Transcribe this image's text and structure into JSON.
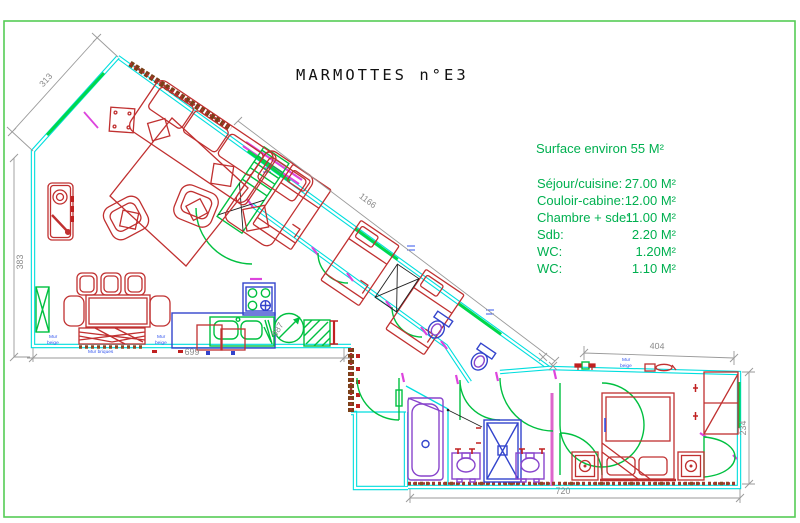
{
  "sheet": {
    "title": "MARMOTTES n°E3"
  },
  "legend": {
    "surface_total": "Surface environ 55 M²",
    "rows": [
      {
        "label": "Séjour/cuisine:",
        "value": "27.00 M²"
      },
      {
        "label": "Couloir-cabine:",
        "value": "12.00 M²"
      },
      {
        "label": "Chambre + sde:",
        "value": "11.00 M²"
      },
      {
        "label": "Sdb:",
        "value": "2.20 M²"
      },
      {
        "label": "WC:",
        "value": "1.20M²"
      },
      {
        "label": "WC:",
        "value": "1.10 M²"
      }
    ]
  },
  "dimensions": {
    "diag_top_left": "313",
    "left_vertical": "383",
    "facade_diagonal": "1166",
    "kitchen_bottom": "699",
    "bedroom_top": "404",
    "bedroom_bottom": "720",
    "bedroom_right": "234",
    "stair_circle": "987"
  },
  "wall_labels": {
    "left": {
      "l1": "Mur",
      "l2": "beige"
    },
    "center": {
      "l1": "Mur briques",
      "l2": ""
    },
    "right": {
      "l1": "Mur",
      "l2": "beige"
    },
    "bedroom": {
      "l1": "Mur",
      "l2": "beige"
    }
  },
  "colors": {
    "wall_cyan": "#00dede",
    "annotation_green": "#00c040",
    "legend_green": "#00b050",
    "furniture_red": "#c03030",
    "fixture_blue": "#3344cc",
    "fixture_purple": "#8844cc",
    "door_frame_magenta": "#dd44dd",
    "dimension_gray": "#8a8a8a",
    "label_blue": "#3355ee",
    "brick_brown": "#7a4018",
    "title_black": "#111111"
  }
}
